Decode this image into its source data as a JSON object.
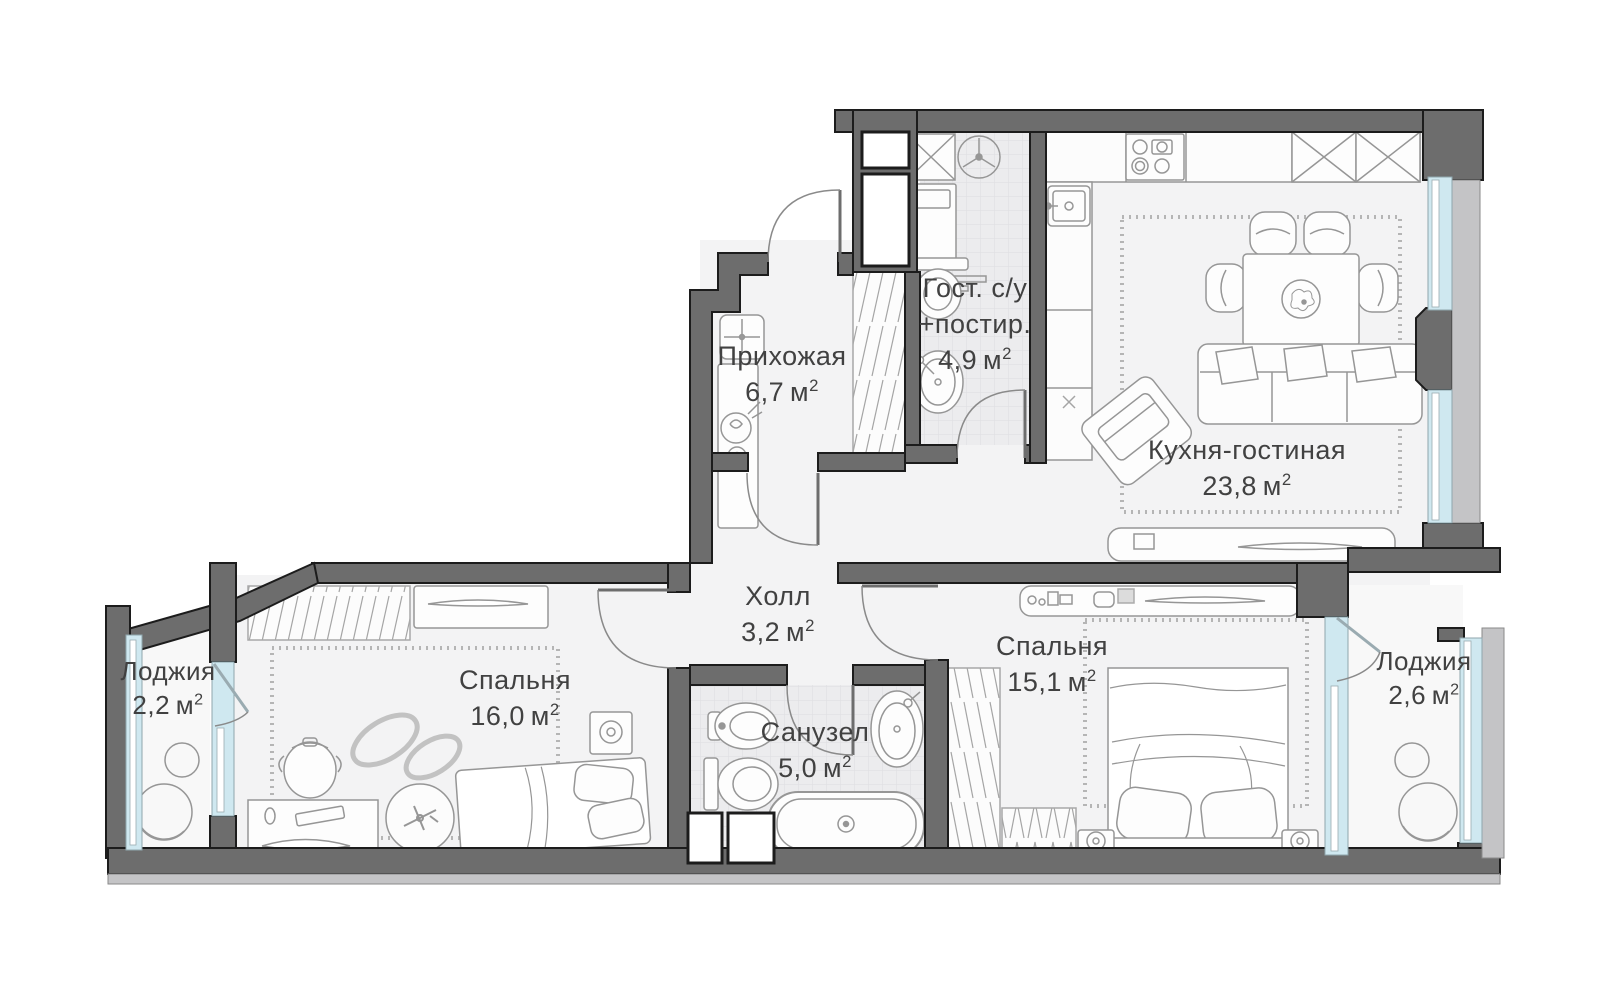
{
  "unit": {
    "symbol": "м",
    "sup": "2"
  },
  "rooms": {
    "hallway": {
      "name": "Прихожая",
      "area": "6,7"
    },
    "guest_wc": {
      "name": "Гост. с/у",
      "name2": "+постир.",
      "area": "4,9"
    },
    "kitchen_living": {
      "name": "Кухня-гостиная",
      "area": "23,8"
    },
    "hall": {
      "name": "Холл",
      "area": "3,2"
    },
    "bedroom_child": {
      "name": "Спальня",
      "area": "16,0"
    },
    "bathroom": {
      "name": "Санузел",
      "area": "5,0"
    },
    "bedroom_master": {
      "name": "Спальня",
      "area": "15,1"
    },
    "loggia_left": {
      "name": "Лоджия",
      "area": "2,2"
    },
    "loggia_right": {
      "name": "Лоджия",
      "area": "2,6"
    }
  },
  "colors": {
    "wall": "#6d6d6d",
    "wall_outline": "#1c1c1c",
    "glazing": "#cfe8f0",
    "floor": "#f3f3f4",
    "loggia_floor": "#f8f8f8",
    "tile": "#ececee",
    "facade": "#c4c4c6",
    "furniture_line": "#969696",
    "carpet_dash": "#b5b5b5",
    "label_text": "#414141"
  }
}
